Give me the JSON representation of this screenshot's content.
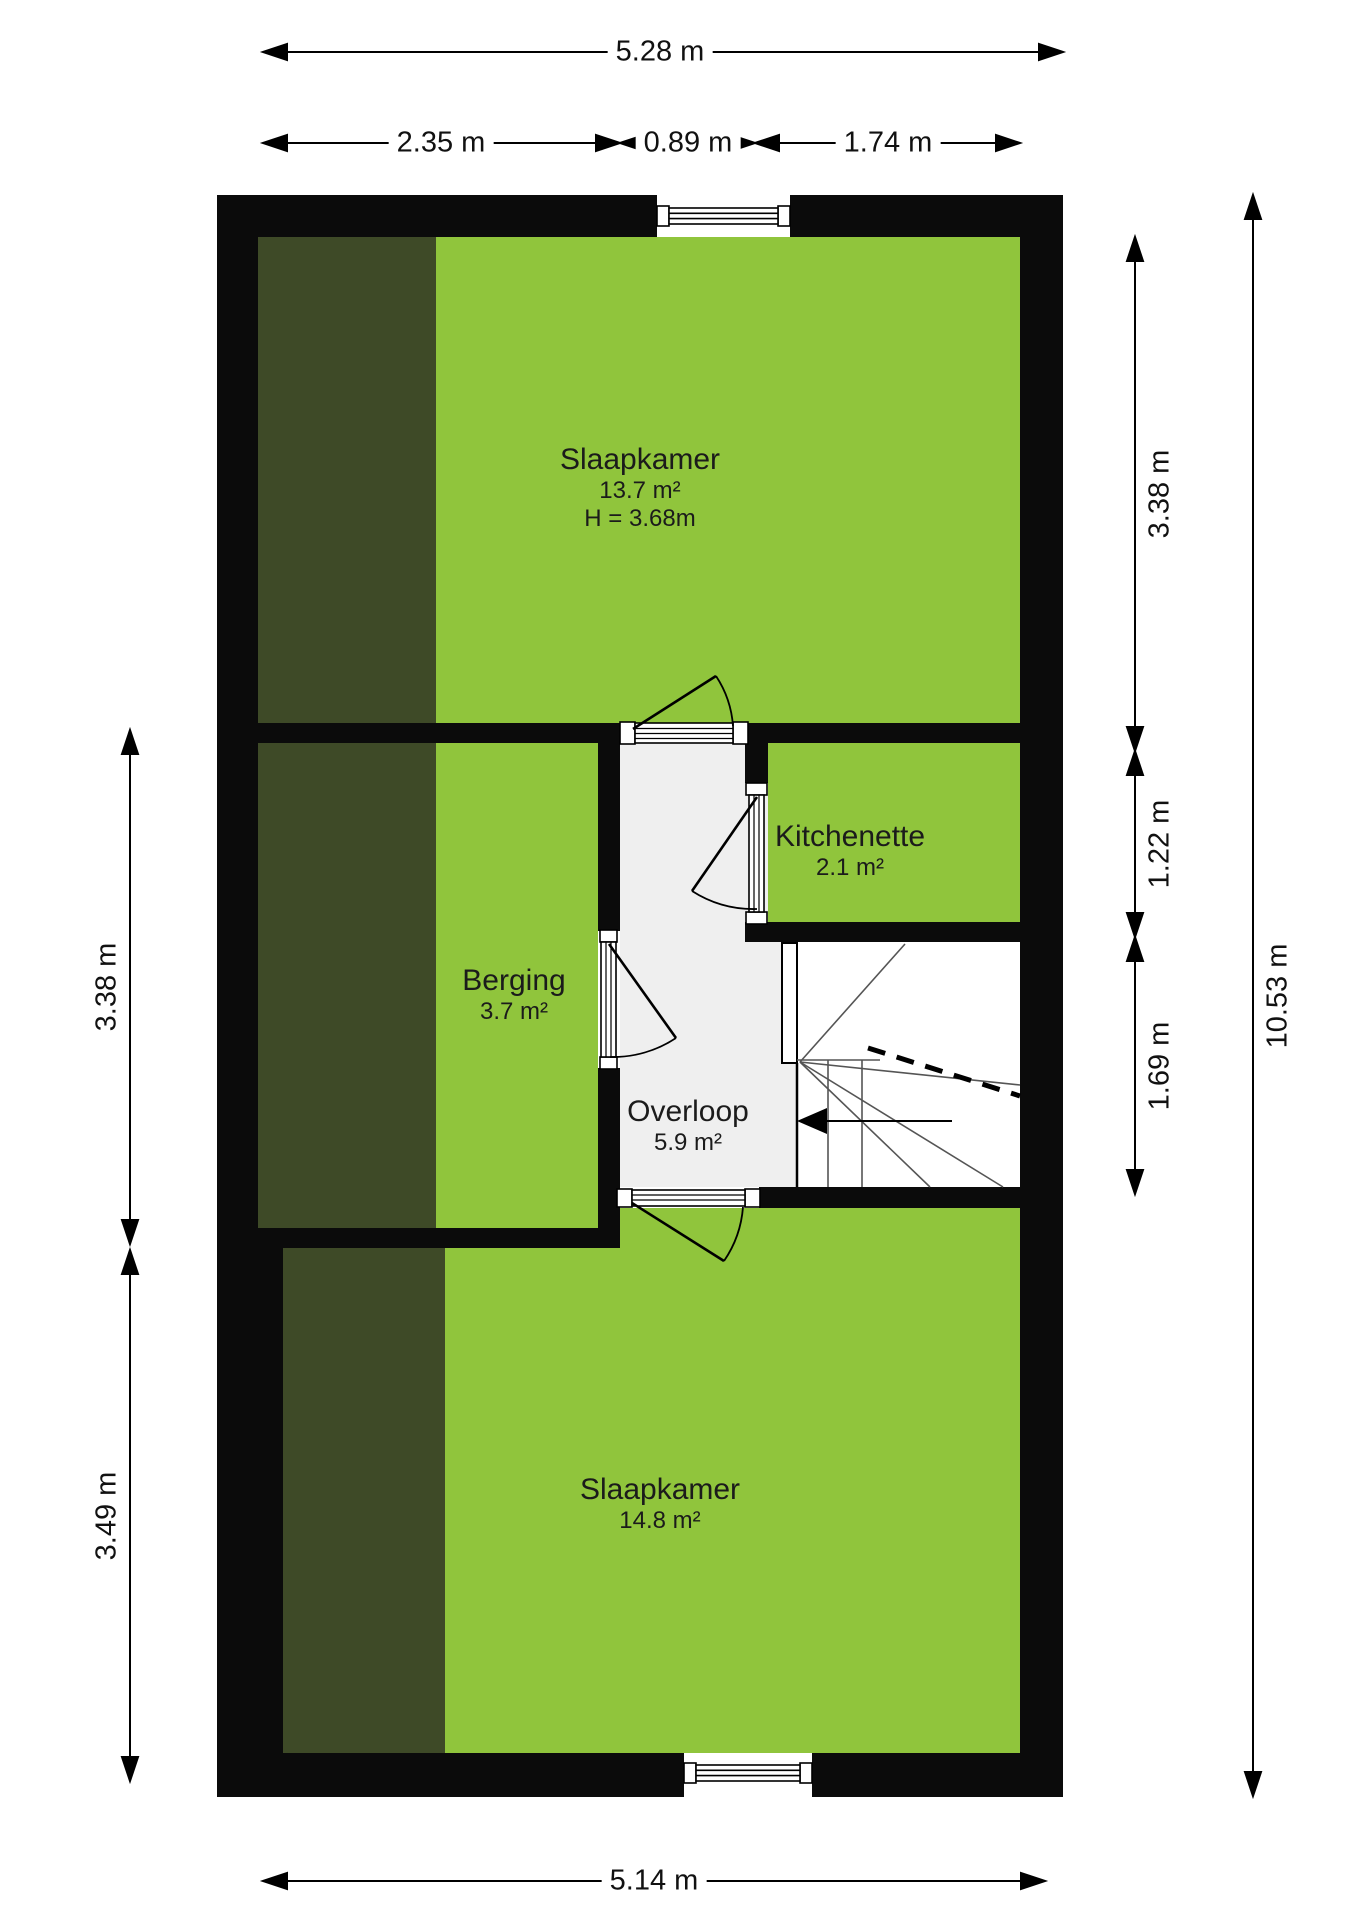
{
  "title": "floor-plan",
  "colors": {
    "room_green": "#90C53C",
    "slope_dark_green": "#3E4A27",
    "wall_black": "#0b0b0b",
    "landing_gray": "#efefef",
    "stair_white": "#ffffff"
  },
  "rooms": {
    "bedroom_top": {
      "name": "Slaapkamer",
      "area": "13.7 m²",
      "height": "H = 3.68m"
    },
    "kitchenette": {
      "name": "Kitchenette",
      "area": "2.1 m²"
    },
    "berging": {
      "name": "Berging",
      "area": "3.7 m²"
    },
    "overloop": {
      "name": "Overloop",
      "area": "5.9 m²"
    },
    "bedroom_bottom": {
      "name": "Slaapkamer",
      "area": "14.8 m²"
    }
  },
  "dimensions": {
    "top_total": "5.28 m",
    "top_segments": [
      "2.35 m",
      "0.89 m",
      "1.74 m"
    ],
    "left": [
      "3.38 m",
      "3.49 m"
    ],
    "right": [
      "3.38 m",
      "1.22 m",
      "1.69 m"
    ],
    "right_total": "10.53 m",
    "bottom_total": "5.14 m"
  }
}
